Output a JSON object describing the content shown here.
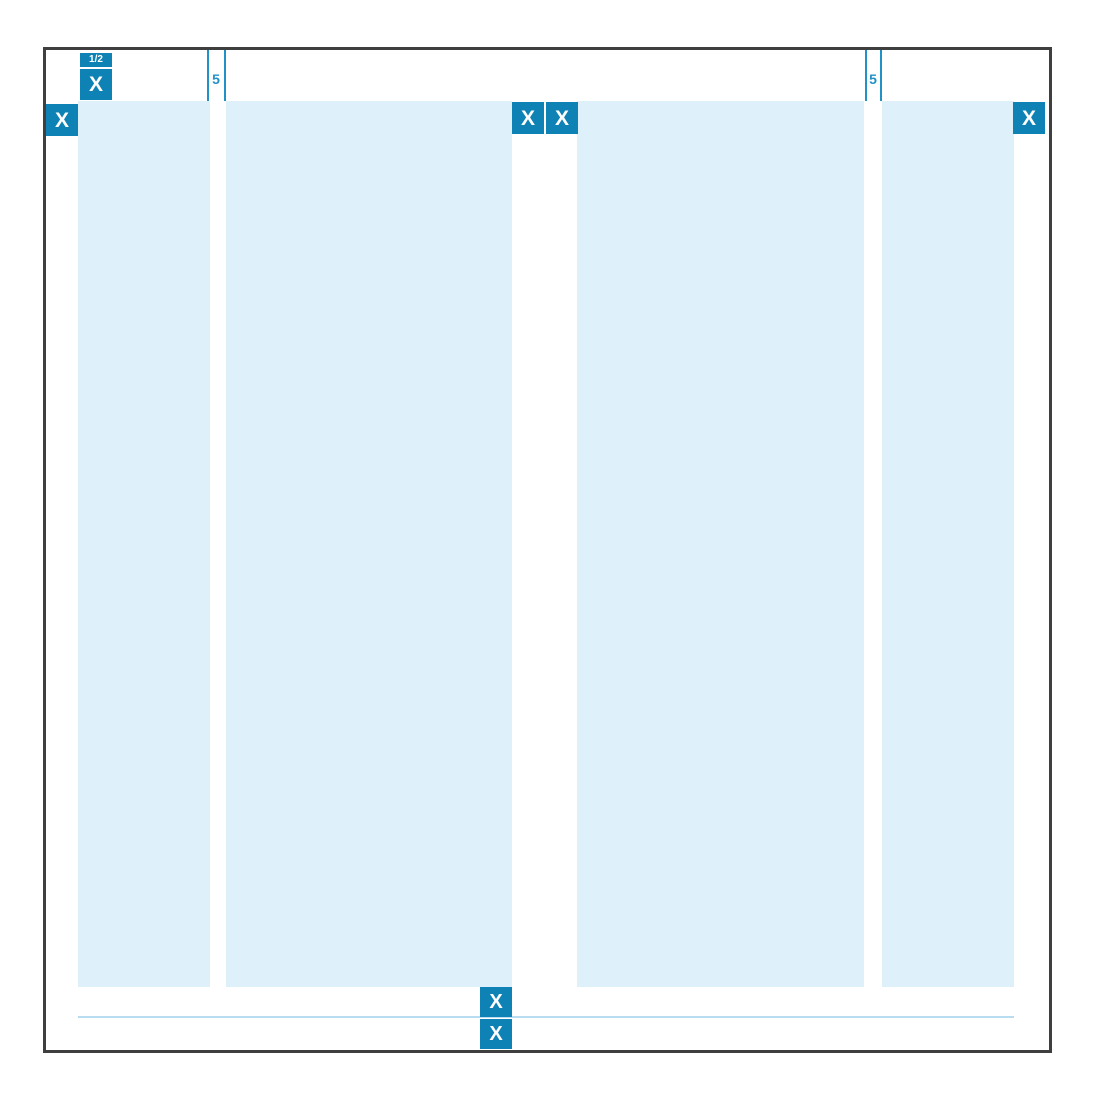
{
  "diagram": {
    "type": "layout-grid-specification",
    "description": "Page grid diagram: frame with four columns, margin and gutter sizes marked with X unit badges",
    "unit_labels": {
      "x": "X",
      "half": "1/2",
      "small_gutter": "5"
    },
    "colors": {
      "badge_blue": "#0e82b4",
      "column_fill": "#def0fa",
      "tick_blue": "#2191c8",
      "rule_blue": "#b9dcf0",
      "frame_border": "#3f3f3f",
      "background": "#ffffff"
    },
    "structure": {
      "column_count": 4,
      "top_margin": "1/2 X + X",
      "left_margin": "X",
      "right_margin": "X",
      "center_gutter": "X + X",
      "small_gutter": "5",
      "bottom_margin": "X + X"
    }
  }
}
